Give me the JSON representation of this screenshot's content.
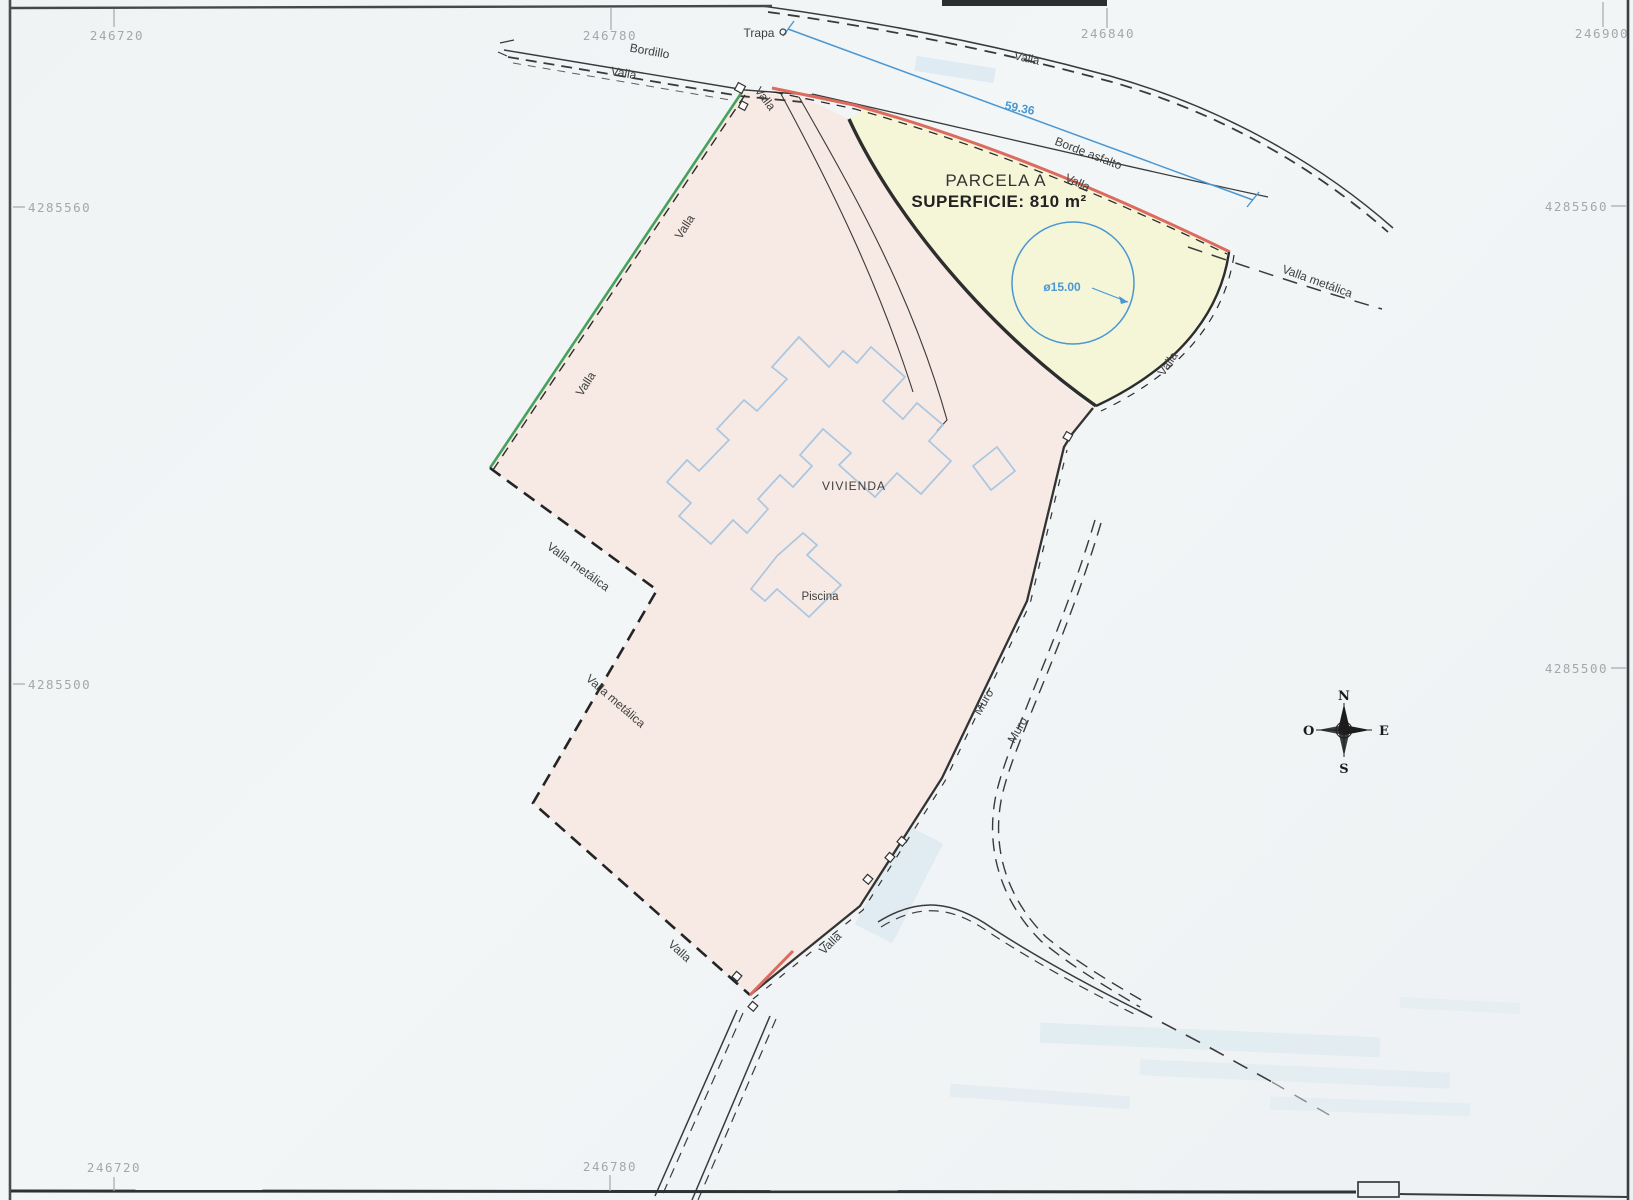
{
  "parcel": {
    "title": "PARCELA A",
    "surface": "SUPERFICIE: 810 m²"
  },
  "features": {
    "vivienda": "VIVIENDA",
    "piscina": "Piscina",
    "trapa": "Trapa"
  },
  "boundaries": {
    "valla": "Valla",
    "valla_metalica": "Valla metálica",
    "muro": "Muro",
    "bordillo": "Bordillo",
    "borde_asfalto": "Borde asfalto"
  },
  "dimensions": {
    "road_frontage": "59.36",
    "circle_diameter": "ø15.00"
  },
  "coordinates": {
    "top": [
      {
        "value": "246720"
      },
      {
        "value": "246780"
      },
      {
        "value": "246840"
      },
      {
        "value": "246900"
      }
    ],
    "bottom": [
      {
        "value": "246720"
      },
      {
        "value": "246780"
      }
    ],
    "left": [
      {
        "value": "4285560"
      },
      {
        "value": "4285500"
      }
    ],
    "right": [
      {
        "value": "4285560"
      },
      {
        "value": "4285500"
      }
    ]
  },
  "compass": {
    "n": "N",
    "s": "S",
    "e": "E",
    "o": "O"
  },
  "colors": {
    "parcel_pink": "#f7e9e3",
    "parcel_yellow": "#f5f5d8",
    "boundary_red": "#dd6a5e",
    "boundary_green": "#46a15e",
    "dim_blue": "#4a97d2",
    "building_blue": "#a9c7e2",
    "line_dark": "#3a3a3a",
    "coord_gray": "#a3a8ab"
  }
}
